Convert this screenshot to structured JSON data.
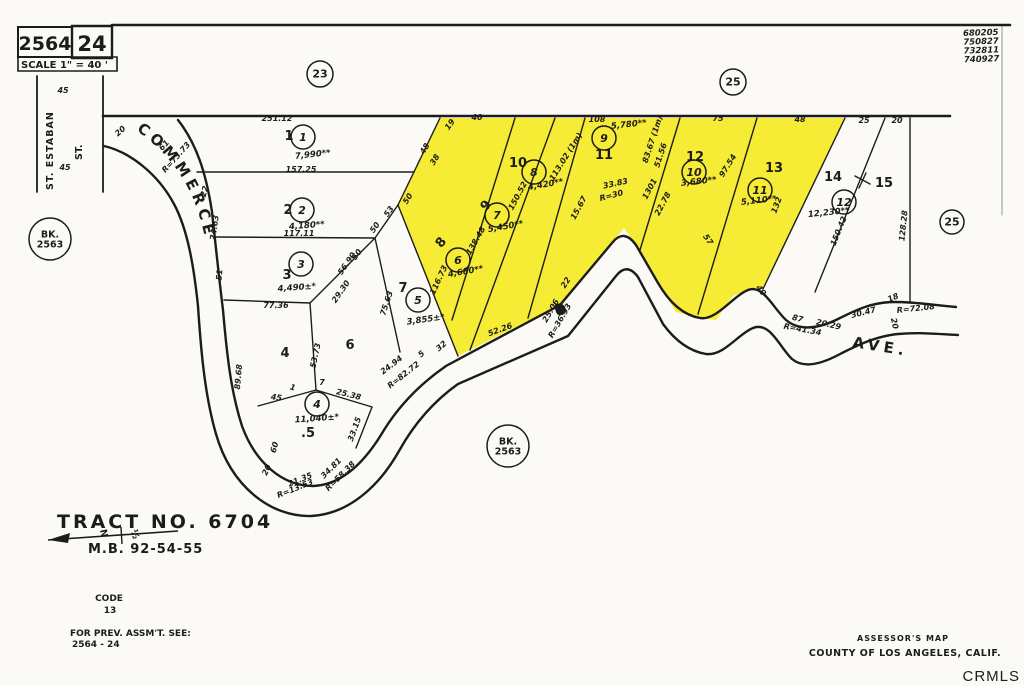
{
  "colors": {
    "highlight": "#f6ec35",
    "ink": "#1c1c1c",
    "watermark": "#b9b9b9"
  },
  "header": {
    "book": "2564",
    "page": "24",
    "scale": "SCALE 1\" = 40 '"
  },
  "stamps": [
    "680205",
    "750827",
    "732811",
    "740927"
  ],
  "streets": {
    "commerce": "COMMERCE",
    "ave": "AVE.",
    "st_estaban": "ST. ESTABAN",
    "st": "ST."
  },
  "north_arrow": {
    "n": "N",
    "frac": "½"
  },
  "footer": {
    "tract": "TRACT  NO.  6704",
    "map_book": "M.B.  92-54-55",
    "code_label": "CODE",
    "code": "13",
    "prev_line1": "FOR PREV. ASSM'T. SEE:",
    "prev_line2": "2564 - 24",
    "assessor_line1": "ASSESSOR'S MAP",
    "assessor_line2": "COUNTY OF LOS ANGELES, CALIF.",
    "watermark": "CRMLS"
  },
  "ref_circles": [
    {
      "lines": [
        "23"
      ],
      "x": 320,
      "y": 74,
      "r": 13
    },
    {
      "lines": [
        "25"
      ],
      "x": 733,
      "y": 82,
      "r": 13
    },
    {
      "lines": [
        "25"
      ],
      "x": 952,
      "y": 222,
      "r": 12
    },
    {
      "lines": [
        "BK.",
        "2563"
      ],
      "x": 50,
      "y": 239,
      "r": 21
    },
    {
      "lines": [
        "BK.",
        "2563"
      ],
      "x": 508,
      "y": 446,
      "r": 21
    }
  ],
  "map": {
    "lots": [
      {
        "n": "1",
        "x": 289,
        "y": 140,
        "rot": 0
      },
      {
        "n": "2",
        "x": 288,
        "y": 214,
        "rot": 0
      },
      {
        "n": "3",
        "x": 287,
        "y": 279,
        "rot": 0
      },
      {
        "n": "4",
        "x": 285,
        "y": 357,
        "rot": 0
      },
      {
        "n": ".5",
        "x": 308,
        "y": 437,
        "rot": 0
      },
      {
        "n": "6",
        "x": 350,
        "y": 349,
        "rot": 0
      },
      {
        "n": "7",
        "x": 403,
        "y": 292,
        "rot": 0
      },
      {
        "n": "8",
        "x": 444,
        "y": 245,
        "rot": -50
      },
      {
        "n": "9",
        "x": 489,
        "y": 208,
        "rot": -50
      },
      {
        "n": "10",
        "x": 518,
        "y": 167,
        "rot": 0
      },
      {
        "n": "11",
        "x": 604,
        "y": 159,
        "rot": 0
      },
      {
        "n": "12",
        "x": 695,
        "y": 161,
        "rot": 0
      },
      {
        "n": "13",
        "x": 774,
        "y": 172,
        "rot": 0
      },
      {
        "n": "14",
        "x": 833,
        "y": 181,
        "rot": 0
      },
      {
        "n": "15",
        "x": 884,
        "y": 187,
        "rot": 0
      }
    ],
    "parcels": [
      {
        "n": "1",
        "x": 303,
        "y": 137,
        "area": "7,990**",
        "ax": 313,
        "ay": 157,
        "ar": -6
      },
      {
        "n": "2",
        "x": 302,
        "y": 210,
        "area": "4,180**",
        "ax": 307,
        "ay": 228,
        "ar": -4
      },
      {
        "n": "3",
        "x": 301,
        "y": 264,
        "area": "4,490±*",
        "ax": 297,
        "ay": 290,
        "ar": -4
      },
      {
        "n": "4",
        "x": 317,
        "y": 404,
        "area": "11,040±*",
        "ax": 317,
        "ay": 421,
        "ar": -4
      },
      {
        "n": "5",
        "x": 418,
        "y": 300,
        "area": "3,855±*",
        "ax": 426,
        "ay": 322,
        "ar": -8
      },
      {
        "n": "6",
        "x": 458,
        "y": 260,
        "area": "4,680**",
        "ax": 466,
        "ay": 274,
        "ar": -10
      },
      {
        "n": "7",
        "x": 497,
        "y": 215,
        "area": "5,450**",
        "ax": 506,
        "ay": 229,
        "ar": -10
      },
      {
        "n": "8",
        "x": 534,
        "y": 172,
        "area": "4,420**",
        "ax": 546,
        "ay": 187,
        "ar": -10
      },
      {
        "n": "9",
        "x": 604,
        "y": 138,
        "area": "5,780**",
        "ax": 629,
        "ay": 127,
        "ar": -6
      },
      {
        "n": "10",
        "x": 694,
        "y": 172,
        "area": "3,680**",
        "ax": 699,
        "ay": 184,
        "ar": -6
      },
      {
        "n": "11",
        "x": 760,
        "y": 190,
        "area": "5,110**",
        "ax": 759,
        "ay": 203,
        "ar": -6
      },
      {
        "n": "12",
        "x": 844,
        "y": 202,
        "area": "12,230**",
        "ax": 829,
        "ay": 215,
        "ar": -6
      }
    ],
    "dimensions": [
      {
        "t": "251.12",
        "x": 277,
        "y": 121,
        "r": 0
      },
      {
        "t": "157.25",
        "x": 301,
        "y": 172,
        "r": 0
      },
      {
        "t": "117.11",
        "x": 299,
        "y": 236,
        "r": 0
      },
      {
        "t": "77.36",
        "x": 276,
        "y": 308,
        "r": 0
      },
      {
        "t": "45",
        "x": 63,
        "y": 93,
        "r": 0
      },
      {
        "t": "45",
        "x": 65,
        "y": 170,
        "r": 0
      },
      {
        "t": "20",
        "x": 122,
        "y": 133,
        "r": -42
      },
      {
        "t": "61",
        "x": 166,
        "y": 147,
        "r": -48
      },
      {
        "t": "R=73.73",
        "x": 178,
        "y": 159,
        "r": -48
      },
      {
        "t": "22",
        "x": 207,
        "y": 192,
        "r": -75
      },
      {
        "t": "24.63",
        "x": 217,
        "y": 228,
        "r": -82
      },
      {
        "t": "51",
        "x": 222,
        "y": 275,
        "r": -85
      },
      {
        "t": "89.68",
        "x": 241,
        "y": 377,
        "r": -85
      },
      {
        "t": "60",
        "x": 277,
        "y": 448,
        "r": -75
      },
      {
        "t": "20",
        "x": 269,
        "y": 471,
        "r": -65
      },
      {
        "t": "21.35",
        "x": 301,
        "y": 482,
        "r": -22
      },
      {
        "t": "R=13.53",
        "x": 296,
        "y": 491,
        "r": -22
      },
      {
        "t": "34.81",
        "x": 333,
        "y": 470,
        "r": -45
      },
      {
        "t": "R=58.38",
        "x": 342,
        "y": 478,
        "r": -45
      },
      {
        "t": "45",
        "x": 276,
        "y": 400,
        "r": 8
      },
      {
        "t": "1",
        "x": 292,
        "y": 390,
        "r": 15
      },
      {
        "t": "7",
        "x": 322,
        "y": 385,
        "r": 0
      },
      {
        "t": "53.73",
        "x": 318,
        "y": 356,
        "r": -78
      },
      {
        "t": "56.90",
        "x": 349,
        "y": 265,
        "r": -55
      },
      {
        "t": "29.30",
        "x": 343,
        "y": 293,
        "r": -55
      },
      {
        "t": "53",
        "x": 391,
        "y": 213,
        "r": -55
      },
      {
        "t": "50",
        "x": 377,
        "y": 229,
        "r": -55
      },
      {
        "t": "50",
        "x": 359,
        "y": 256,
        "r": -55
      },
      {
        "t": "25.38",
        "x": 348,
        "y": 397,
        "r": 14
      },
      {
        "t": "33.15",
        "x": 357,
        "y": 430,
        "r": -70
      },
      {
        "t": "75.63",
        "x": 389,
        "y": 304,
        "r": -72
      },
      {
        "t": "24.94",
        "x": 393,
        "y": 367,
        "r": -38
      },
      {
        "t": "R=82.72",
        "x": 405,
        "y": 377,
        "r": -38
      },
      {
        "t": "5",
        "x": 423,
        "y": 356,
        "r": -40
      },
      {
        "t": "32",
        "x": 443,
        "y": 348,
        "r": -40
      },
      {
        "t": "52.26",
        "x": 501,
        "y": 332,
        "r": -20
      },
      {
        "t": "22",
        "x": 568,
        "y": 284,
        "r": -58
      },
      {
        "t": "25.06",
        "x": 553,
        "y": 312,
        "r": -60
      },
      {
        "t": "R=36.93",
        "x": 562,
        "y": 322,
        "r": -60
      },
      {
        "t": "19",
        "x": 452,
        "y": 126,
        "r": -55
      },
      {
        "t": "40",
        "x": 477,
        "y": 120,
        "r": 0
      },
      {
        "t": "48",
        "x": 427,
        "y": 150,
        "r": -58
      },
      {
        "t": "38",
        "x": 437,
        "y": 161,
        "r": -58
      },
      {
        "t": "50",
        "x": 410,
        "y": 200,
        "r": -58
      },
      {
        "t": "116.73",
        "x": 441,
        "y": 281,
        "r": -65
      },
      {
        "t": "138.48",
        "x": 478,
        "y": 242,
        "r": -60
      },
      {
        "t": "150.52",
        "x": 520,
        "y": 197,
        "r": -62
      },
      {
        "t": "113.02 (1m)",
        "x": 568,
        "y": 158,
        "r": -58
      },
      {
        "t": "108",
        "x": 597,
        "y": 122,
        "r": 0
      },
      {
        "t": "83.67 (1m)",
        "x": 655,
        "y": 140,
        "r": -72
      },
      {
        "t": "51.56",
        "x": 663,
        "y": 156,
        "r": -72
      },
      {
        "t": "33.83",
        "x": 616,
        "y": 186,
        "r": -12
      },
      {
        "t": "R=30",
        "x": 612,
        "y": 198,
        "r": -15
      },
      {
        "t": "15.67",
        "x": 581,
        "y": 209,
        "r": -62
      },
      {
        "t": "1301",
        "x": 652,
        "y": 190,
        "r": -62
      },
      {
        "t": "22.78",
        "x": 665,
        "y": 205,
        "r": -62
      },
      {
        "t": "75",
        "x": 718,
        "y": 121,
        "r": 0
      },
      {
        "t": "97.54",
        "x": 730,
        "y": 167,
        "r": -58
      },
      {
        "t": "57",
        "x": 706,
        "y": 241,
        "r": 55
      },
      {
        "t": "132",
        "x": 779,
        "y": 206,
        "r": -70
      },
      {
        "t": "48",
        "x": 800,
        "y": 122,
        "r": 0
      },
      {
        "t": "25",
        "x": 864,
        "y": 123,
        "r": 0
      },
      {
        "t": "20",
        "x": 897,
        "y": 123,
        "r": 0
      },
      {
        "t": "150.42",
        "x": 841,
        "y": 232,
        "r": -68
      },
      {
        "t": "128.28",
        "x": 906,
        "y": 226,
        "r": -84
      },
      {
        "t": "40",
        "x": 759,
        "y": 292,
        "r": 52
      },
      {
        "t": "87",
        "x": 797,
        "y": 321,
        "r": 14
      },
      {
        "t": "R=41.34",
        "x": 802,
        "y": 332,
        "r": 10
      },
      {
        "t": "20.29",
        "x": 828,
        "y": 327,
        "r": 12
      },
      {
        "t": "30.47",
        "x": 864,
        "y": 315,
        "r": -14
      },
      {
        "t": "18",
        "x": 894,
        "y": 300,
        "r": -22
      },
      {
        "t": "R=72.08",
        "x": 916,
        "y": 311,
        "r": -6
      },
      {
        "t": "20",
        "x": 892,
        "y": 324,
        "r": 78
      }
    ]
  }
}
